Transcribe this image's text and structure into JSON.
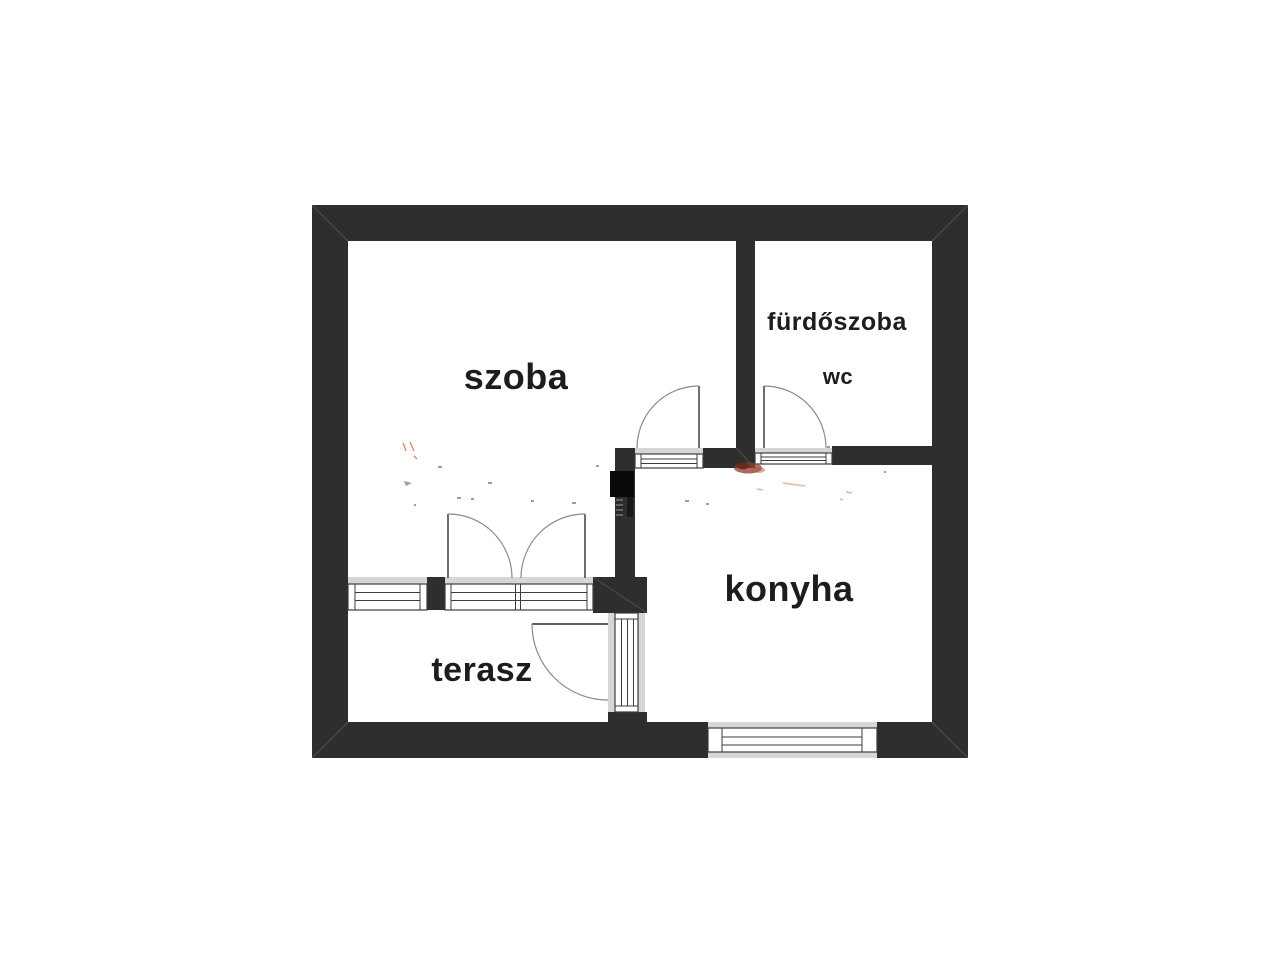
{
  "page": {
    "background": "#ffffff",
    "kind": "floor-plan"
  },
  "floor_plan": {
    "language": "hu",
    "rooms": {
      "szoba": {
        "label": "szoba"
      },
      "furdoszoba": {
        "label": "fürdőszoba"
      },
      "wc": {
        "label": "wc"
      },
      "konyha": {
        "label": "konyha"
      },
      "terasz": {
        "label": "terasz"
      }
    },
    "colors": {
      "wall": "#2e2e2f",
      "wall_dark_flue": "#0a0a0a",
      "frame_band": "#d6d6d6",
      "frame_line": "#3d3d3d",
      "door_leaf": "#4a4a4a",
      "door_arc": "#8a8a8a",
      "label": "#1d1d1d",
      "watermark_orange": "#dd6a45",
      "watermark_smudge": "#8f3c2c",
      "watermark_gray": "#7a7f88"
    }
  }
}
